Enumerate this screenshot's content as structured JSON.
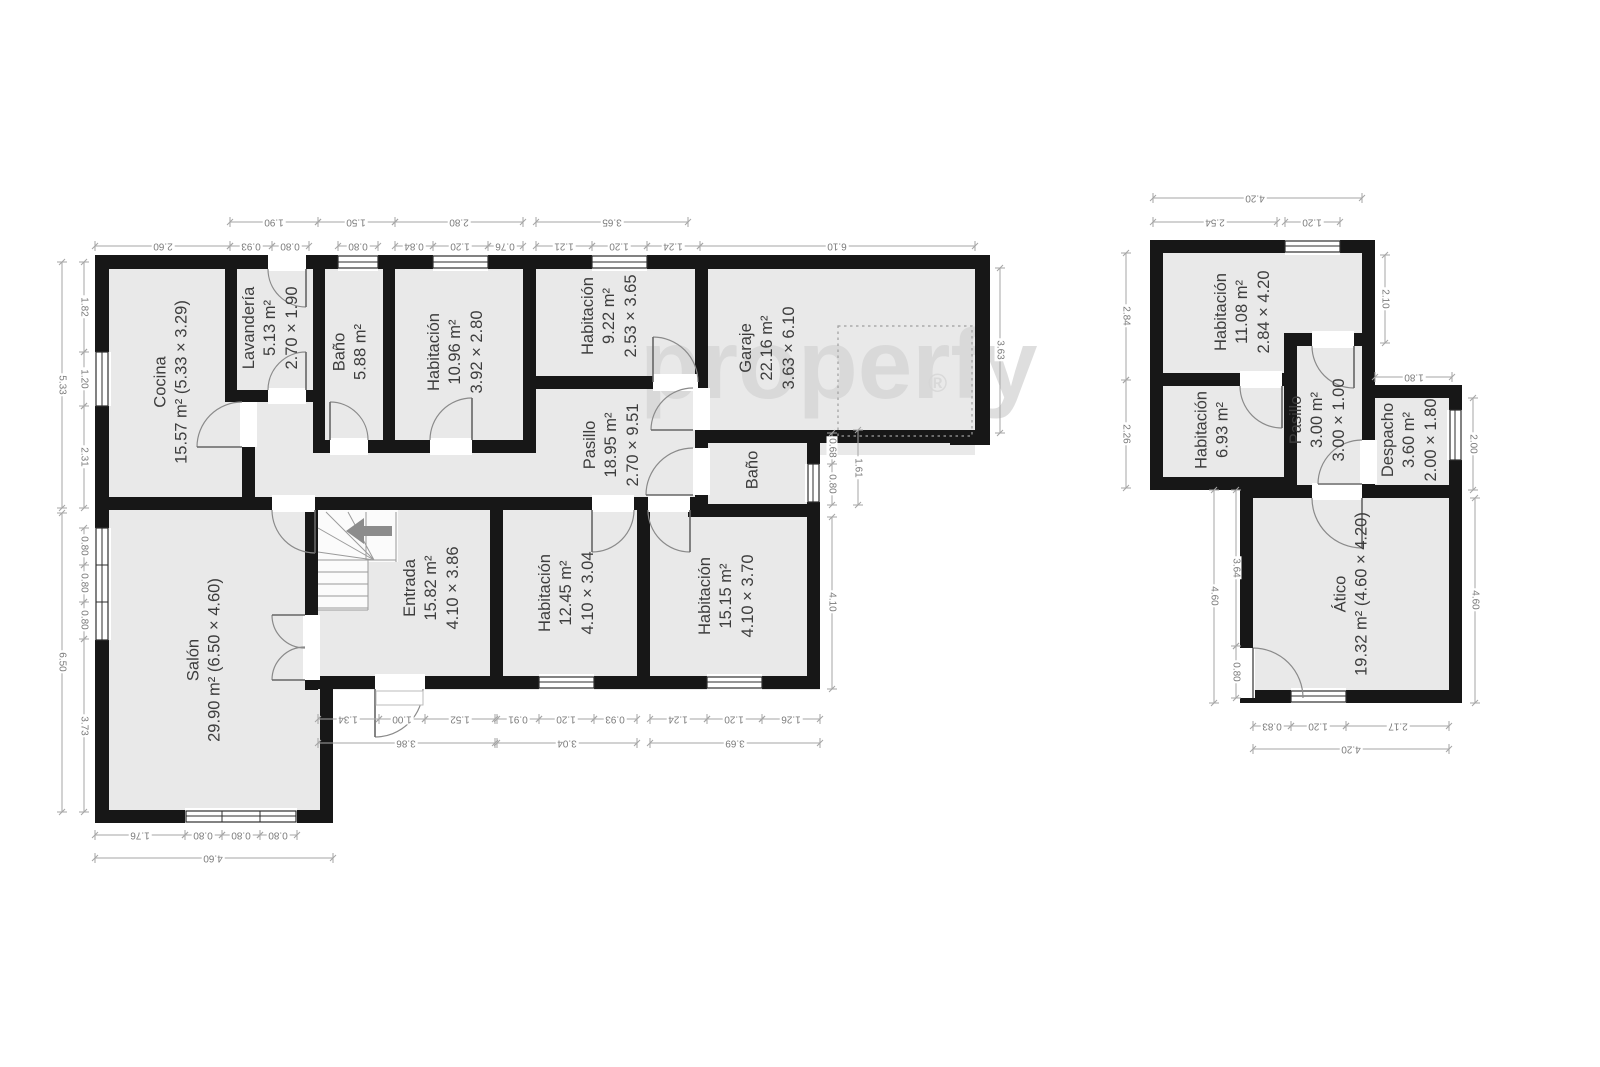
{
  "watermark": {
    "text": "properfy",
    "registered": "®"
  },
  "rooms": [
    {
      "k": "cocina",
      "x": 172,
      "y": 382,
      "lines": [
        "Cocina",
        "15.57 m² (5.33 × 3.29)"
      ]
    },
    {
      "k": "lavanderia",
      "x": 271,
      "y": 328,
      "lines": [
        "Lavandería",
        "5.13 m²",
        "2.70 × 1.90"
      ]
    },
    {
      "k": "bano-top",
      "x": 351,
      "y": 352,
      "lines": [
        "Baño",
        "5.88 m²"
      ]
    },
    {
      "k": "habitacion-1096",
      "x": 456,
      "y": 352,
      "lines": [
        "Habitación",
        "10.96 m²",
        "3.92 × 2.80"
      ]
    },
    {
      "k": "habitacion-922",
      "x": 610,
      "y": 316,
      "lines": [
        "Habitación",
        "9.22 m²",
        "2.53 × 3.65"
      ]
    },
    {
      "k": "garaje",
      "x": 768,
      "y": 348,
      "lines": [
        "Garaje",
        "22.16 m²",
        "3.63 × 6.10"
      ]
    },
    {
      "k": "pasillo-principal",
      "x": 612,
      "y": 445,
      "lines": [
        "Pasillo",
        "18.95 m²",
        "2.70 × 9.51"
      ]
    },
    {
      "k": "bano-small",
      "x": 753,
      "y": 470,
      "lines": [
        "Baño"
      ]
    },
    {
      "k": "salon",
      "x": 205,
      "y": 660,
      "lines": [
        "Salón",
        "29.90 m² (6.50 × 4.60)"
      ]
    },
    {
      "k": "entrada",
      "x": 432,
      "y": 588,
      "lines": [
        "Entrada",
        "15.82 m²",
        "4.10 × 3.86"
      ]
    },
    {
      "k": "habitacion-1245",
      "x": 567,
      "y": 593,
      "lines": [
        "Habitación",
        "12.45 m²",
        "4.10 × 3.04"
      ]
    },
    {
      "k": "habitacion-1515",
      "x": 727,
      "y": 596,
      "lines": [
        "Habitación",
        "15.15 m²",
        "4.10 × 3.70"
      ]
    },
    {
      "k": "habitacion-1108",
      "x": 1243,
      "y": 312,
      "lines": [
        "Habitación",
        "11.08 m²",
        "2.84 × 4.20"
      ]
    },
    {
      "k": "habitacion-693",
      "x": 1213,
      "y": 430,
      "lines": [
        "Habitación",
        "6.93 m²"
      ]
    },
    {
      "k": "pasillo-atico",
      "x": 1318,
      "y": 420,
      "lines": [
        "Pasillo",
        "3.00 m²",
        "3.00 × 1.00"
      ]
    },
    {
      "k": "despacho",
      "x": 1410,
      "y": 440,
      "lines": [
        "Despacho",
        "3.60 m²",
        "2.00 × 1.80"
      ]
    },
    {
      "k": "atico",
      "x": 1352,
      "y": 594,
      "lines": [
        "Ático",
        "19.32 m² (4.60 × 4.20)"
      ]
    }
  ],
  "dims": [
    {
      "t": "1.90",
      "x": 274,
      "y": 222,
      "r": 180,
      "l": [
        230,
        222,
        318,
        222
      ]
    },
    {
      "t": "1.50",
      "x": 356,
      "y": 222,
      "r": 180,
      "l": [
        318,
        222,
        395,
        222
      ]
    },
    {
      "t": "2.80",
      "x": 459,
      "y": 222,
      "r": 180,
      "l": [
        395,
        222,
        523,
        222
      ]
    },
    {
      "t": "3.65",
      "x": 612,
      "y": 222,
      "r": 180,
      "l": [
        536,
        222,
        688,
        222
      ]
    },
    {
      "t": "2.60",
      "x": 163,
      "y": 246,
      "r": 180,
      "l": [
        95,
        246,
        230,
        246
      ]
    },
    {
      "t": "0.93",
      "x": 251,
      "y": 246,
      "r": 180,
      "l": [
        230,
        246,
        272,
        246
      ]
    },
    {
      "t": "0.80",
      "x": 290,
      "y": 246,
      "r": 180,
      "l": [
        272,
        246,
        309,
        246
      ]
    },
    {
      "t": "0.80",
      "x": 358,
      "y": 246,
      "r": 180,
      "l": [
        338,
        246,
        378,
        246
      ]
    },
    {
      "t": "0.84",
      "x": 414,
      "y": 246,
      "r": 180,
      "l": [
        395,
        246,
        433,
        246
      ]
    },
    {
      "t": "1.20",
      "x": 460,
      "y": 246,
      "r": 180,
      "l": [
        433,
        246,
        488,
        246
      ]
    },
    {
      "t": "0.76",
      "x": 505,
      "y": 246,
      "r": 180,
      "l": [
        488,
        246,
        523,
        246
      ]
    },
    {
      "t": "1.21",
      "x": 564,
      "y": 246,
      "r": 180,
      "l": [
        536,
        246,
        592,
        246
      ]
    },
    {
      "t": "1.20",
      "x": 619,
      "y": 246,
      "r": 180,
      "l": [
        592,
        246,
        647,
        246
      ]
    },
    {
      "t": "1.24",
      "x": 673,
      "y": 246,
      "r": 180,
      "l": [
        647,
        246,
        700,
        246
      ]
    },
    {
      "t": "6.10",
      "x": 837,
      "y": 246,
      "r": 180,
      "l": [
        700,
        246,
        975,
        246
      ]
    },
    {
      "t": "5.33",
      "x": 62,
      "y": 385,
      "r": 90,
      "l": [
        62,
        262,
        62,
        508
      ]
    },
    {
      "t": "1.82",
      "x": 84,
      "y": 307,
      "r": 90,
      "l": [
        84,
        262,
        84,
        352
      ]
    },
    {
      "t": "1.20",
      "x": 84,
      "y": 379,
      "r": 90,
      "l": [
        84,
        352,
        84,
        406
      ]
    },
    {
      "t": "2.31",
      "x": 84,
      "y": 457,
      "r": 90,
      "l": [
        84,
        406,
        84,
        508
      ]
    },
    {
      "t": "6.50",
      "x": 62,
      "y": 662,
      "r": 90,
      "l": [
        62,
        513,
        62,
        812
      ]
    },
    {
      "t": "0.80",
      "x": 84,
      "y": 546,
      "r": 90,
      "l": [
        84,
        528,
        84,
        565
      ]
    },
    {
      "t": "0.80",
      "x": 84,
      "y": 583,
      "r": 90,
      "l": [
        84,
        565,
        84,
        602
      ]
    },
    {
      "t": "0.80",
      "x": 84,
      "y": 620,
      "r": 90,
      "l": [
        84,
        602,
        84,
        639
      ]
    },
    {
      "t": "3.73",
      "x": 84,
      "y": 726,
      "r": 90,
      "l": [
        84,
        639,
        84,
        812
      ]
    },
    {
      "t": "1.34",
      "x": 348,
      "y": 719,
      "r": 180,
      "l": [
        318,
        719,
        379,
        719
      ]
    },
    {
      "t": "1.00",
      "x": 402,
      "y": 719,
      "r": 180,
      "l": [
        379,
        719,
        425,
        719
      ]
    },
    {
      "t": "1.52",
      "x": 460,
      "y": 719,
      "r": 180,
      "l": [
        425,
        719,
        495,
        719
      ]
    },
    {
      "t": "0.91",
      "x": 518,
      "y": 719,
      "r": 180,
      "l": [
        497,
        719,
        539,
        719
      ]
    },
    {
      "t": "1.20",
      "x": 566,
      "y": 719,
      "r": 180,
      "l": [
        539,
        719,
        594,
        719
      ]
    },
    {
      "t": "0.93",
      "x": 615,
      "y": 719,
      "r": 180,
      "l": [
        594,
        719,
        637,
        719
      ]
    },
    {
      "t": "1.24",
      "x": 678,
      "y": 719,
      "r": 180,
      "l": [
        650,
        719,
        707,
        719
      ]
    },
    {
      "t": "1.20",
      "x": 734,
      "y": 719,
      "r": 180,
      "l": [
        707,
        719,
        762,
        719
      ]
    },
    {
      "t": "1.26",
      "x": 791,
      "y": 719,
      "r": 180,
      "l": [
        762,
        719,
        820,
        719
      ]
    },
    {
      "t": "3.86",
      "x": 406,
      "y": 743,
      "r": 180,
      "l": [
        318,
        743,
        495,
        743
      ]
    },
    {
      "t": "3.04",
      "x": 567,
      "y": 743,
      "r": 180,
      "l": [
        497,
        743,
        637,
        743
      ]
    },
    {
      "t": "3.69",
      "x": 735,
      "y": 743,
      "r": 180,
      "l": [
        650,
        743,
        820,
        743
      ]
    },
    {
      "t": "1.76",
      "x": 140,
      "y": 835,
      "r": 180,
      "l": [
        95,
        835,
        185,
        835
      ]
    },
    {
      "t": "0.80",
      "x": 203,
      "y": 835,
      "r": 180,
      "l": [
        185,
        835,
        222,
        835
      ]
    },
    {
      "t": "0.80",
      "x": 241,
      "y": 835,
      "r": 180,
      "l": [
        222,
        835,
        260,
        835
      ]
    },
    {
      "t": "0.80",
      "x": 278,
      "y": 835,
      "r": 180,
      "l": [
        260,
        835,
        297,
        835
      ]
    },
    {
      "t": "4.60",
      "x": 213,
      "y": 858,
      "r": 180,
      "l": [
        95,
        858,
        333,
        858
      ]
    },
    {
      "t": "3.63",
      "x": 1000,
      "y": 350,
      "r": 90,
      "l": [
        1000,
        268,
        1000,
        433
      ]
    },
    {
      "t": "0.68",
      "x": 832,
      "y": 448,
      "r": 90,
      "l": [
        832,
        433,
        832,
        464
      ]
    },
    {
      "t": "0.80",
      "x": 832,
      "y": 484,
      "r": 90,
      "l": [
        832,
        464,
        832,
        505
      ]
    },
    {
      "t": "1.61",
      "x": 858,
      "y": 468,
      "r": 90,
      "l": [
        858,
        430,
        858,
        505
      ]
    },
    {
      "t": "4.10",
      "x": 832,
      "y": 602,
      "r": 90,
      "l": [
        832,
        517,
        832,
        689
      ]
    },
    {
      "t": "4.20",
      "x": 1255,
      "y": 198,
      "r": 180,
      "l": [
        1153,
        198,
        1362,
        198
      ]
    },
    {
      "t": "2.54",
      "x": 1215,
      "y": 222,
      "r": 180,
      "l": [
        1153,
        222,
        1277,
        222
      ]
    },
    {
      "t": "1.20",
      "x": 1312,
      "y": 222,
      "r": 180,
      "l": [
        1285,
        222,
        1340,
        222
      ]
    },
    {
      "t": "2.84",
      "x": 1126,
      "y": 316,
      "r": 90,
      "l": [
        1126,
        253,
        1126,
        380
      ]
    },
    {
      "t": "2.26",
      "x": 1126,
      "y": 434,
      "r": 90,
      "l": [
        1126,
        380,
        1126,
        488
      ]
    },
    {
      "t": "2.10",
      "x": 1385,
      "y": 299,
      "r": 90,
      "l": [
        1385,
        255,
        1385,
        343
      ]
    },
    {
      "t": "1.80",
      "x": 1414,
      "y": 377,
      "r": 180,
      "l": [
        1375,
        377,
        1452,
        377
      ]
    },
    {
      "t": "2.00",
      "x": 1473,
      "y": 444,
      "r": 90,
      "l": [
        1473,
        398,
        1473,
        490
      ]
    },
    {
      "t": "4.60",
      "x": 1214,
      "y": 596,
      "r": 90,
      "l": [
        1214,
        490,
        1214,
        703
      ]
    },
    {
      "t": "3.64",
      "x": 1236,
      "y": 568,
      "r": 90,
      "l": [
        1236,
        490,
        1236,
        646
      ]
    },
    {
      "t": "0.80",
      "x": 1236,
      "y": 672,
      "r": 90,
      "l": [
        1236,
        646,
        1236,
        698
      ]
    },
    {
      "t": "4.60",
      "x": 1475,
      "y": 600,
      "r": 90,
      "l": [
        1475,
        498,
        1475,
        703
      ]
    },
    {
      "t": "0.83",
      "x": 1272,
      "y": 726,
      "r": 180,
      "l": [
        1253,
        726,
        1291,
        726
      ]
    },
    {
      "t": "1.20",
      "x": 1318,
      "y": 726,
      "r": 180,
      "l": [
        1291,
        726,
        1346,
        726
      ]
    },
    {
      "t": "2.17",
      "x": 1398,
      "y": 726,
      "r": 180,
      "l": [
        1346,
        726,
        1449,
        726
      ]
    },
    {
      "t": "4.20",
      "x": 1351,
      "y": 749,
      "r": 180,
      "l": [
        1253,
        749,
        1449,
        749
      ]
    }
  ]
}
